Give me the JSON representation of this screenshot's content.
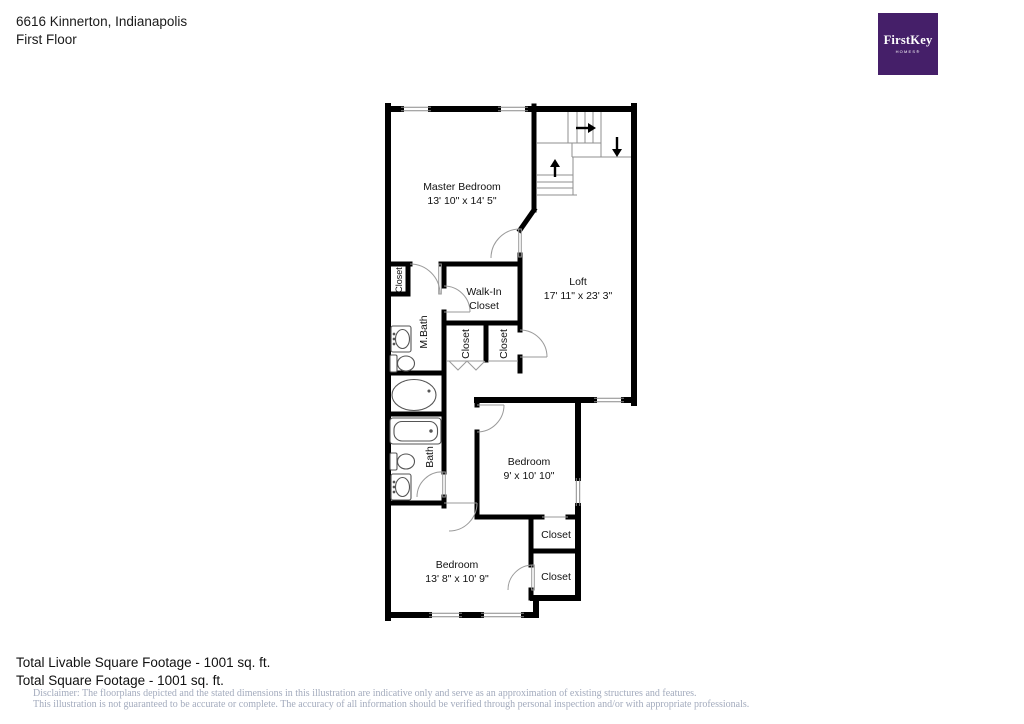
{
  "header": {
    "address": "6616 Kinnerton, Indianapolis",
    "floor_label": "First Floor"
  },
  "logo": {
    "brand": "FirstKey",
    "tagline": "HOMES®",
    "bg_color": "#451F69",
    "text_color": "#FFFFFF"
  },
  "floorplan": {
    "rooms": {
      "master_bedroom": {
        "name": "Master Bedroom",
        "dims": "13' 10\" x 14' 5\""
      },
      "loft": {
        "name": "Loft",
        "dims": "17' 11\" x 23' 3\""
      },
      "walk_in_closet": {
        "name_line1": "Walk-In",
        "name_line2": "Closet"
      },
      "m_bath": {
        "name": "M.Bath"
      },
      "bath": {
        "name": "Bath"
      },
      "bedroom_middle": {
        "name": "Bedroom",
        "dims": "9' x 10' 10\""
      },
      "bedroom_bottom": {
        "name": "Bedroom",
        "dims": "13' 8\" x 10' 9\""
      },
      "closet_master": {
        "name": "Closet"
      },
      "closet_hall_left": {
        "name": "Closet"
      },
      "closet_hall_right": {
        "name": "Closet"
      },
      "closet_bedroom_upper": {
        "name": "Closet"
      },
      "closet_bedroom_lower": {
        "name": "Closet"
      }
    },
    "stairs": {
      "arrows": [
        "right",
        "down",
        "up"
      ]
    },
    "fixtures": [
      "sink",
      "toilet",
      "garden-tub",
      "bathtub",
      "toilet",
      "sink"
    ]
  },
  "footer": {
    "livable": "Total Livable Square Footage - 1001 sq. ft.",
    "total": "Total Square Footage - 1001 sq. ft.",
    "disclaimer_line1": "Disclaimer: The floorplans depicted and the stated dimensions in this illustration are indicative only and serve as an approximation of existing structures and features.",
    "disclaimer_line2": "This illustration is not guaranteed to be accurate or complete. The accuracy of all information should be verified through personal inspection and/or with appropriate professionals."
  }
}
